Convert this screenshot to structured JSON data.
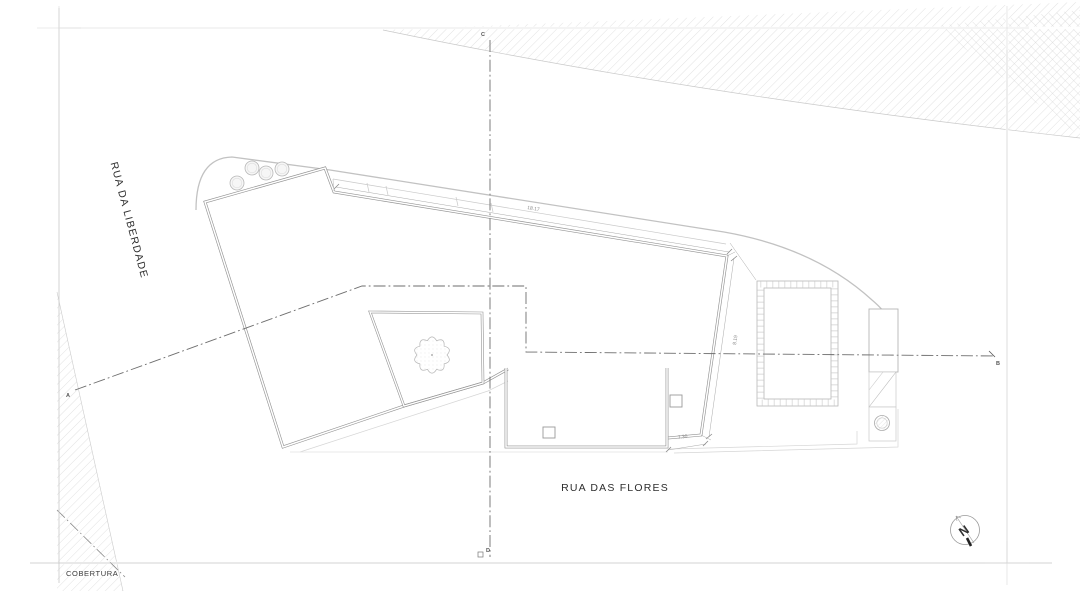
{
  "sheet": {
    "title": "COBERTURA"
  },
  "streets": {
    "left": "RUA DA LIBERDADE",
    "bottom": "RUA DAS FLORES"
  },
  "section_markers": {
    "a": "A",
    "b": "B",
    "c": "C",
    "d": "D"
  },
  "dimensions": {
    "top_edge": "18.17",
    "right_edge": "8.19",
    "bottom_edge": "7.30"
  },
  "north_arrow": {
    "label": "N"
  },
  "colors": {
    "line_light": "#c9c9c9",
    "line_mid": "#969696",
    "section_line": "#6e6e6e",
    "hatch": "#cfcfcf",
    "text_dark": "#2e2e2e"
  }
}
